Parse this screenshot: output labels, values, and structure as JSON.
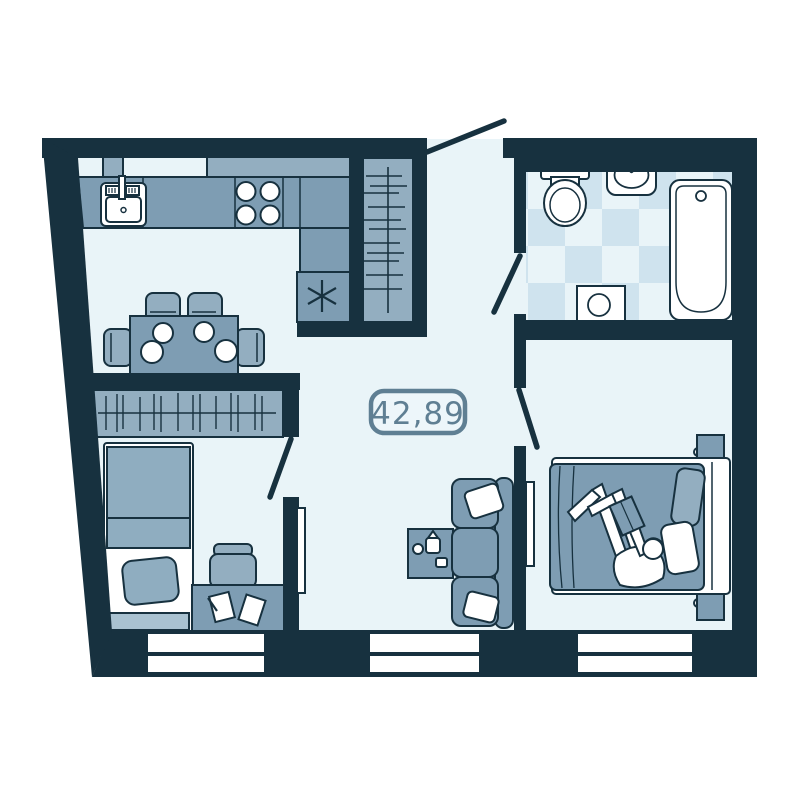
{
  "area_label": {
    "value": "42,89"
  },
  "palette": {
    "wall": "#17313f",
    "floor": "#e9f4f8",
    "outside": "#ffffff",
    "furniture": "#7e9db3",
    "furniture_light": "#93aec0",
    "furniture_pale": "#a9c2d1",
    "bed_blanket": "#8fadc0",
    "tile": "#cfe3ee",
    "fixture_white": "#ffffff",
    "label_accent": "#5f7f93"
  },
  "fixtures": {
    "kitchen": [
      "kitchen-counter",
      "kitchen-upper-cabinet",
      "sink",
      "stove-four-burner",
      "appliance-asterisk",
      "dining-table",
      "dining-chairs",
      "plates"
    ],
    "hallway": [
      "entry-door",
      "coat-closet-with-hangers"
    ],
    "bathroom": [
      "toilet",
      "washbasin",
      "washing-machine",
      "bathtub",
      "checkered-tile-floor",
      "bathroom-door"
    ],
    "living_area": [
      "three-seat-sofa",
      "sofa-pillows",
      "coffee-table",
      "wall-tv"
    ],
    "bedroom_left": [
      "wardrobe-with-hangers",
      "single-bed",
      "pillow",
      "desk",
      "desk-chair",
      "paper-sheets",
      "door"
    ],
    "bedroom_right": [
      "double-bed",
      "person-reading-book",
      "pillows",
      "nightstand",
      "nightstand",
      "wall-tv",
      "door"
    ],
    "windows": {
      "count": 3
    }
  }
}
